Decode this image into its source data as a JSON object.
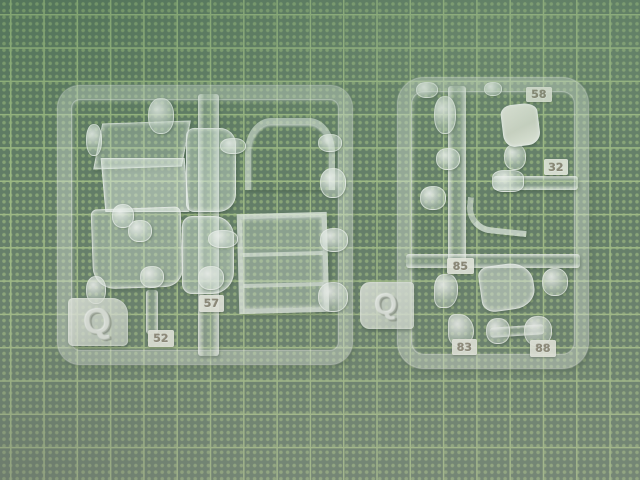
{
  "colors": {
    "mat_base": "#68806c",
    "mat_grid": "#a9c38c",
    "mat_dot": "#93ad7e",
    "tag_text": "#8f8878",
    "plastic": "#eef5ef"
  },
  "left_sprue": {
    "gate_letter": "Q",
    "part_tags": [
      {
        "label": "52"
      },
      {
        "label": "57"
      }
    ]
  },
  "right_sprue": {
    "gate_letter": "Q",
    "part_tags": [
      {
        "label": "58"
      },
      {
        "label": "32"
      },
      {
        "label": "85"
      },
      {
        "label": "83"
      },
      {
        "label": "88"
      }
    ]
  }
}
